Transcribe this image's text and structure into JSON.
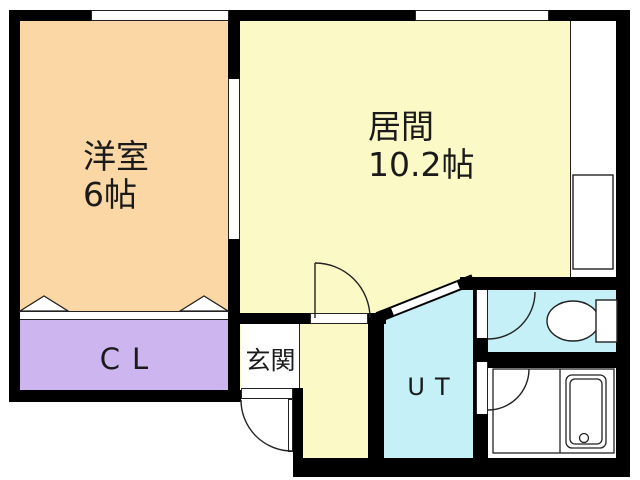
{
  "floorplan": {
    "type": "apartment-floor-plan",
    "rooms": {
      "yoshitsu": {
        "label": "洋室",
        "size": "6帖",
        "color": "#FAD7A5"
      },
      "ima": {
        "label": "居間",
        "size": "10.2帖",
        "color": "#FBF9C5"
      },
      "cl": {
        "label": "CL",
        "color": "#CDB5F0"
      },
      "genkan": {
        "label": "玄関",
        "color": "#FFFFFF"
      },
      "ut": {
        "label": "UT",
        "color": "#C5F0F7"
      },
      "toilet": {
        "label": "",
        "color": "#C5F0F7"
      },
      "bathroom": {
        "label": "",
        "color": "#FFFFFF"
      }
    },
    "colors": {
      "wall": "#000000",
      "background": "#FFFFFF",
      "line": "#222222"
    },
    "fixtures": [
      "toilet",
      "bathtub",
      "closet-folding-doors",
      "entrance-door",
      "sliding-partition-door",
      "diagonal-door",
      "windows"
    ]
  }
}
